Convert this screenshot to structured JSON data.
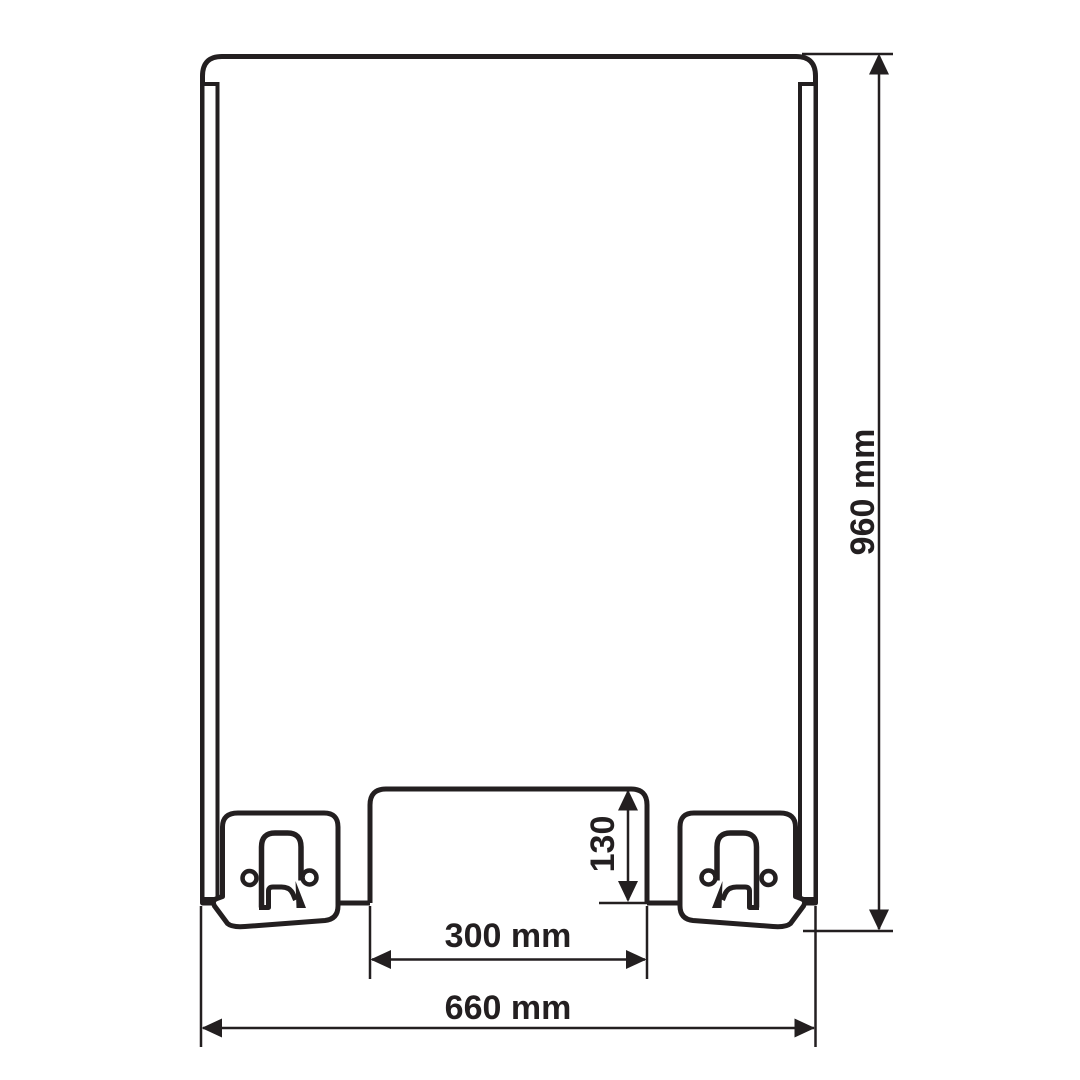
{
  "diagram": {
    "type": "technical-drawing",
    "labels": {
      "overall_height": "960 mm",
      "overall_width": "660 mm",
      "opening_width": "300 mm",
      "opening_height": "130"
    },
    "icons": {
      "foot_clamp": "clamp-bracket-icon",
      "screw": "screw-hole-icon"
    },
    "colors": {
      "line": "#231f20",
      "background": "#ffffff"
    }
  }
}
